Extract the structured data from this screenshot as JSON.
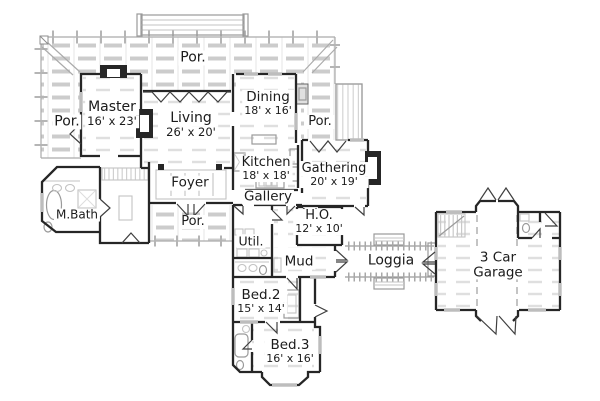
{
  "colors": {
    "background": "#ffffff",
    "wall": "#262626",
    "light": "#9a9a9a",
    "hatch": "#cccccc",
    "text": "#1b1b1b"
  },
  "plan": {
    "description": "Single-story house first floor plan",
    "rooms": [
      {
        "id": "porch-top",
        "lines": [
          {
            "text": "Por.",
            "size": 14
          }
        ],
        "x": 193,
        "y": 58
      },
      {
        "id": "porch-left",
        "lines": [
          {
            "text": "Por.",
            "size": 14
          }
        ],
        "x": 67,
        "y": 122
      },
      {
        "id": "master",
        "lines": [
          {
            "text": "Master",
            "size": 14
          },
          {
            "text": "16' x 23'",
            "size": 11.5
          }
        ],
        "x": 112,
        "y": 114
      },
      {
        "id": "living",
        "lines": [
          {
            "text": "Living",
            "size": 14
          },
          {
            "text": "26' x 20'",
            "size": 11.5
          }
        ],
        "x": 191,
        "y": 125
      },
      {
        "id": "dining",
        "lines": [
          {
            "text": "Dining",
            "size": 13.5
          },
          {
            "text": "18' x 16'",
            "size": 11
          }
        ],
        "x": 268,
        "y": 103
      },
      {
        "id": "porch-right",
        "lines": [
          {
            "text": "Por.",
            "size": 13
          }
        ],
        "x": 320,
        "y": 122
      },
      {
        "id": "kitchen",
        "lines": [
          {
            "text": "Kitchen",
            "size": 13
          },
          {
            "text": "18' x 18'",
            "size": 11
          }
        ],
        "x": 266,
        "y": 169
      },
      {
        "id": "gathering",
        "lines": [
          {
            "text": "Gathering",
            "size": 13
          },
          {
            "text": "20' x 19'",
            "size": 11
          }
        ],
        "x": 334,
        "y": 175
      },
      {
        "id": "foyer",
        "lines": [
          {
            "text": "Foyer",
            "size": 13.5
          }
        ],
        "x": 190,
        "y": 183
      },
      {
        "id": "gallery",
        "lines": [
          {
            "text": "Gallery",
            "size": 13.5
          }
        ],
        "x": 268,
        "y": 197
      },
      {
        "id": "mbath",
        "lines": [
          {
            "text": "M.Bath",
            "size": 12
          }
        ],
        "x": 77,
        "y": 215
      },
      {
        "id": "porch-front",
        "lines": [
          {
            "text": "Por.",
            "size": 13
          }
        ],
        "x": 193,
        "y": 222
      },
      {
        "id": "home-office",
        "lines": [
          {
            "text": "H.O.",
            "size": 13
          },
          {
            "text": "12' x 10'",
            "size": 11
          }
        ],
        "x": 319,
        "y": 222
      },
      {
        "id": "utility",
        "lines": [
          {
            "text": "Util.",
            "size": 12.5
          }
        ],
        "x": 251,
        "y": 241
      },
      {
        "id": "mud",
        "lines": [
          {
            "text": "Mud",
            "size": 13.5
          }
        ],
        "x": 299,
        "y": 262
      },
      {
        "id": "loggia",
        "lines": [
          {
            "text": "Loggia",
            "size": 14
          }
        ],
        "x": 391,
        "y": 261
      },
      {
        "id": "bed2",
        "lines": [
          {
            "text": "Bed.2",
            "size": 13.5
          },
          {
            "text": "15' x 14'",
            "size": 11
          }
        ],
        "x": 261,
        "y": 301
      },
      {
        "id": "bed3",
        "lines": [
          {
            "text": "Bed.3",
            "size": 13.5
          },
          {
            "text": "16' x 16'",
            "size": 11
          }
        ],
        "x": 290,
        "y": 351
      },
      {
        "id": "garage",
        "lines": [
          {
            "text": "3 Car",
            "size": 13.5
          },
          {
            "text": "Garage",
            "size": 13.5
          }
        ],
        "x": 498,
        "y": 265
      }
    ]
  }
}
